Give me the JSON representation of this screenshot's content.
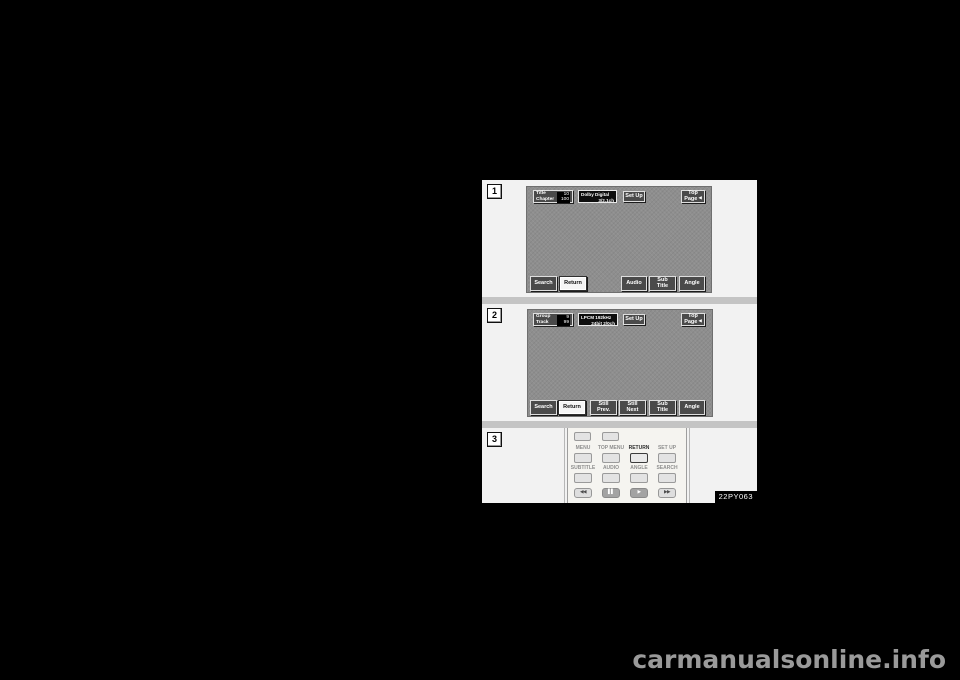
{
  "page": {
    "figure_code": "22PY063",
    "watermark": "carmanualsonline.info",
    "colors": {
      "page_bg": "#000000",
      "figure_bg": "#f2f2f2",
      "screen_bg": "#8e8e8e",
      "button_dark": "#4a4a4a",
      "button_highlight": "#f5f5f5"
    }
  },
  "panels": {
    "p1": {
      "number": "1",
      "title_label": "Title",
      "title_value": "10",
      "chapter_label": "Chapter",
      "chapter_value": "100",
      "audio_line1": "Dolby Digital",
      "audio_line2": "3/2.1ch",
      "setup": "Set Up",
      "top": "Top",
      "page": "Page",
      "arrow": "◀",
      "search": "Search",
      "return": "Return",
      "audio_btn": "Audio",
      "sub": "Sub",
      "title_btn": "Title",
      "angle": "Angle"
    },
    "p2": {
      "number": "2",
      "group_label": "Group",
      "group_value": "9",
      "track_label": "Track",
      "track_value": "99",
      "audio_line1": "LPCM 192kHz",
      "audio_line2": "24bit 2/0ch",
      "setup": "Set Up",
      "top": "Top",
      "page": "Page",
      "arrow": "◀",
      "search": "Search",
      "return": "Return",
      "still_prev_1": "Still",
      "still_prev_2": "Prev.",
      "still_next_1": "Still",
      "still_next_2": "Next",
      "sub": "Sub",
      "title_btn": "Title",
      "angle": "Angle"
    },
    "p3": {
      "number": "3",
      "labels_row1": [
        "MENU",
        "TOP MENU",
        "RETURN",
        "SET UP"
      ],
      "labels_row2": [
        "SUBTITLE",
        "AUDIO",
        "ANGLE",
        "SEARCH"
      ],
      "transport": [
        "◀◀",
        "▌▌",
        "▶",
        "▶▶"
      ]
    }
  }
}
